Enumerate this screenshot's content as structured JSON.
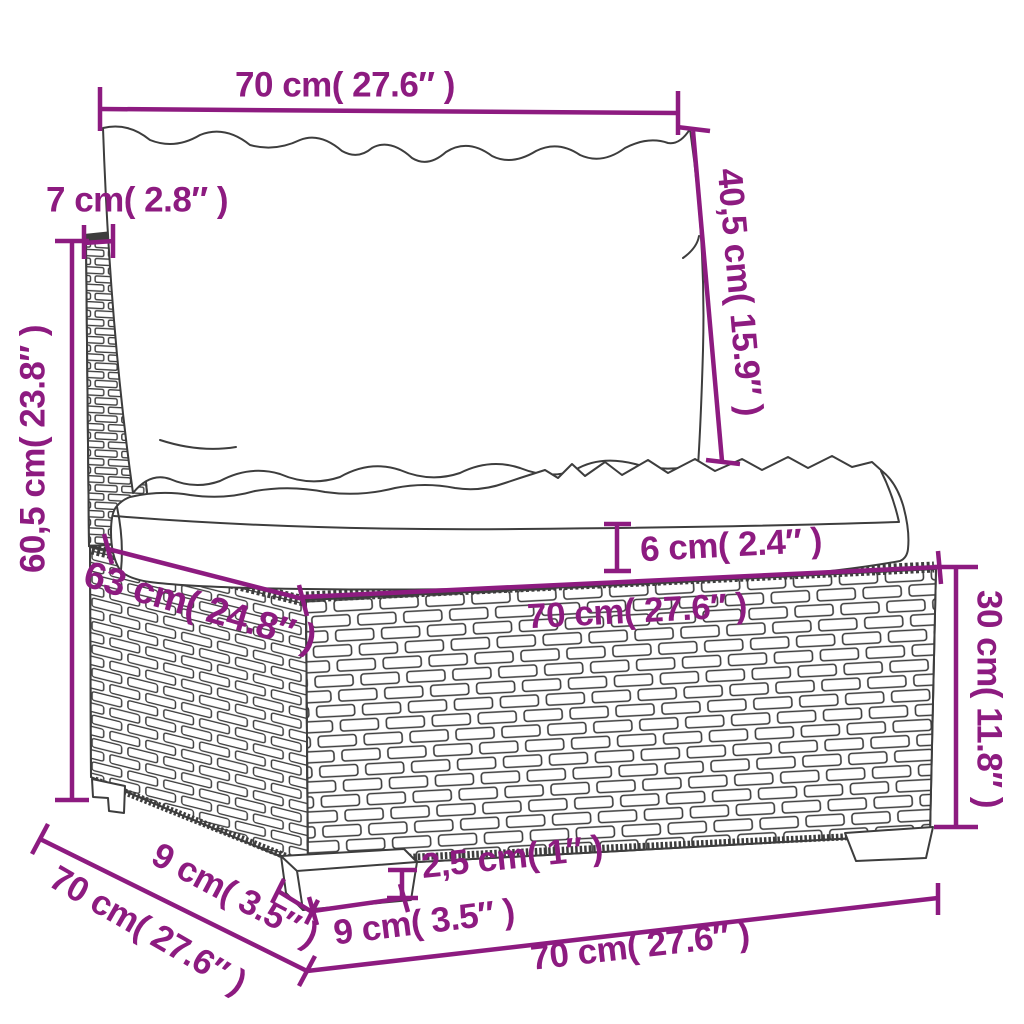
{
  "diagram": {
    "description": "Rattan garden sofa middle section with cushions — dimension drawing",
    "accent_color": "#8d1b80",
    "line_color": "#3d3d3d",
    "background": "#ffffff"
  },
  "labels": {
    "top_width": "70 cm( 27.6″ )",
    "back_thickness": "7 cm( 2.8″ )",
    "back_cushion_height": "40,5 cm( 15.9″ )",
    "total_height": "60,5 cm( 23.8″ )",
    "seat_cushion_thickness": "6 cm( 2.4″ )",
    "seat_depth": "63 cm( 24.8″ )",
    "seat_width": "70 cm( 27.6″ )",
    "base_height": "30 cm( 11.8″ )",
    "leg_height": "2,5 cm( 1″ )",
    "leg_front_width": "9 cm( 3.5″ )",
    "leg_side_depth": "9 cm( 3.5″ )",
    "overall_depth": "70 cm( 27.6″ )",
    "overall_width": "70 cm( 27.6″ )"
  }
}
